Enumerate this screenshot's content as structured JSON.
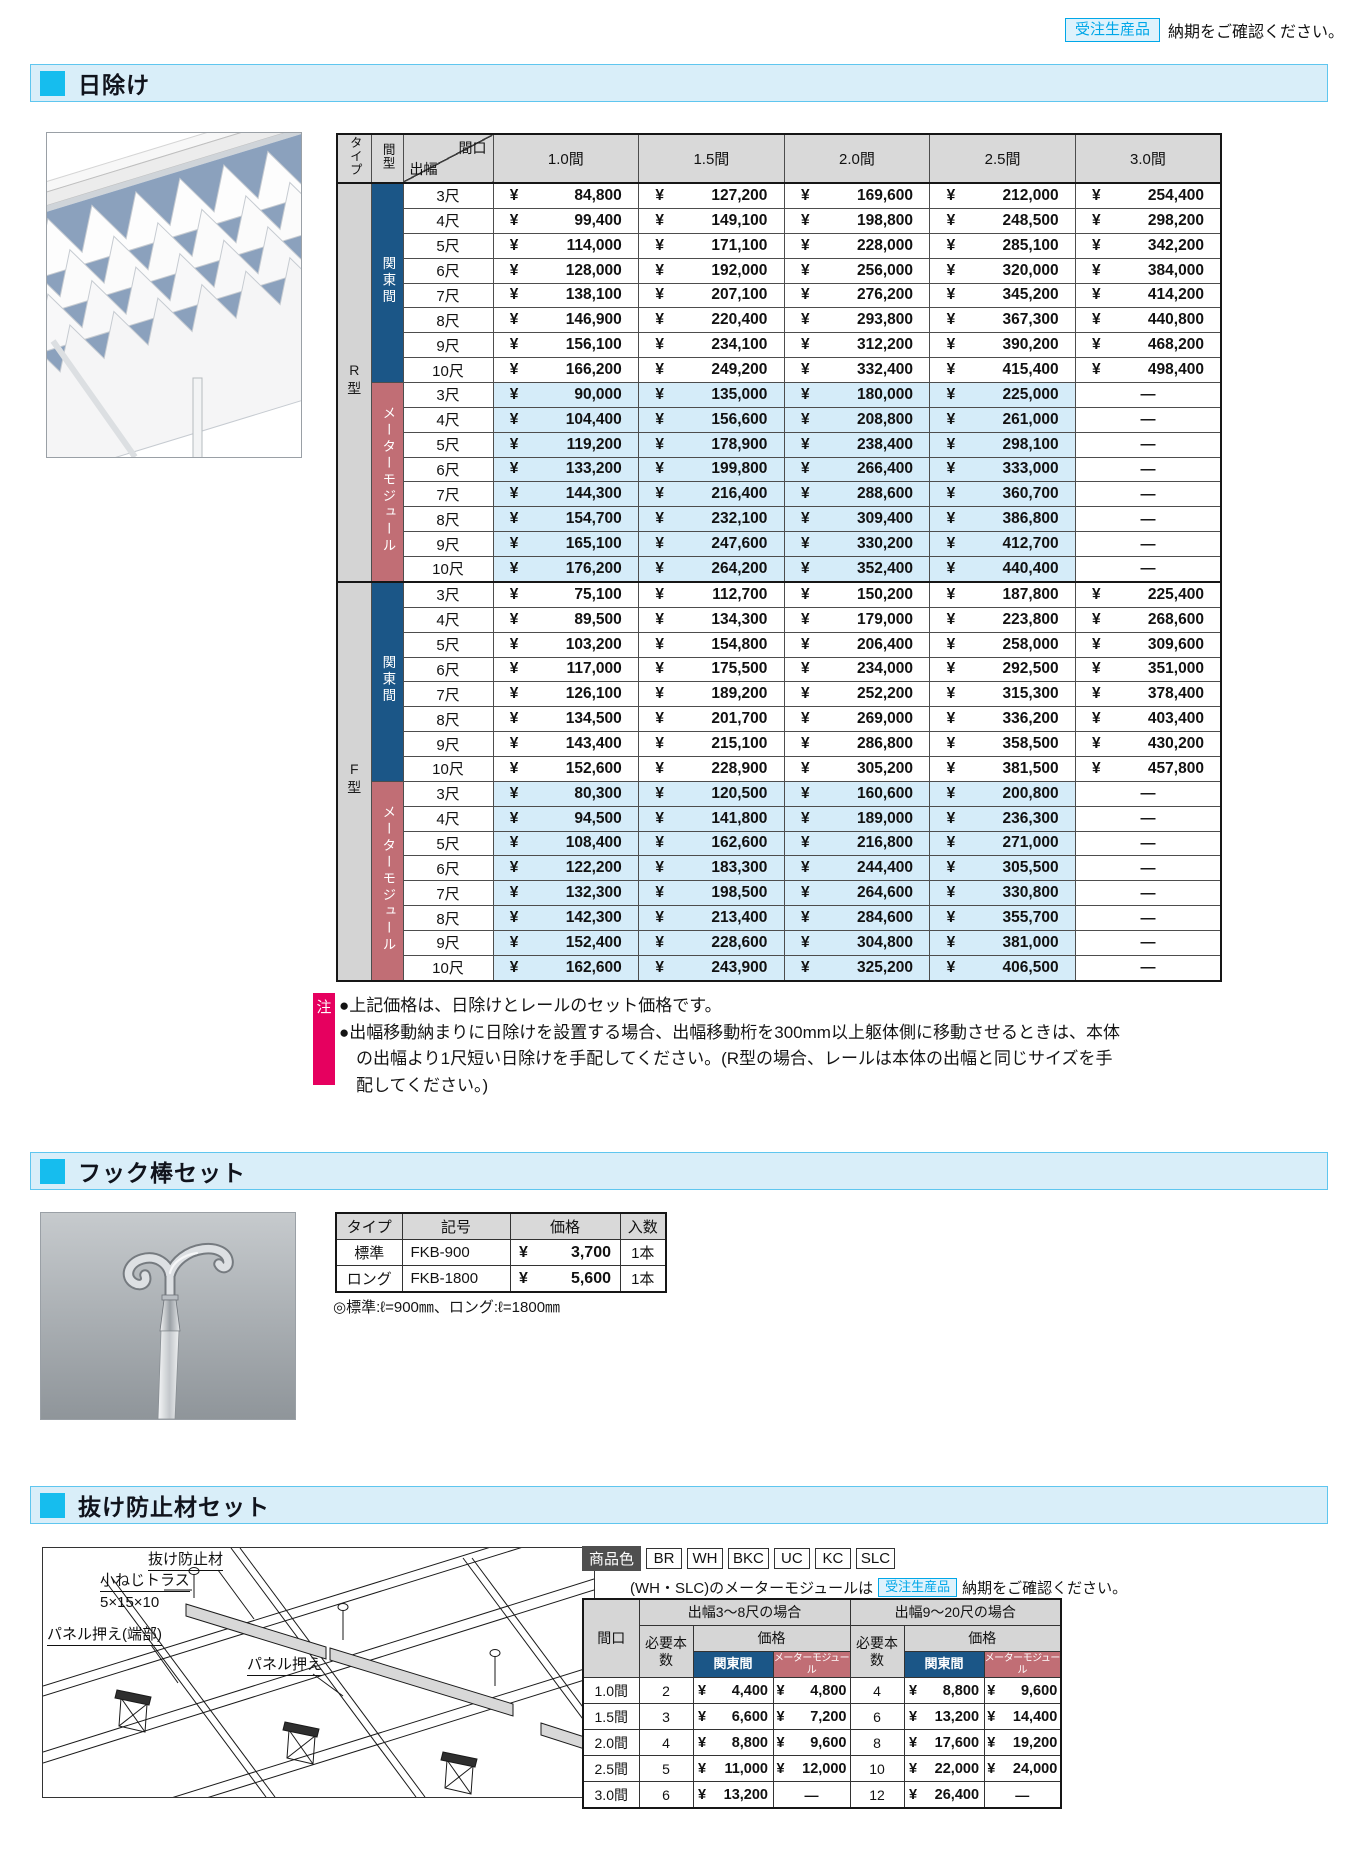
{
  "page": {
    "top_note": {
      "badge": "受注生産品",
      "text": "納期をご確認ください。"
    }
  },
  "colors": {
    "accent_cyan": "#16bdee",
    "section_bar_bg": "#d9eef9",
    "navy_header": "#1b5687",
    "rose_header": "#c16e75",
    "light_blue_cell": "#d5ecf9",
    "note_pink": "#e6005f",
    "badge_cyan": "#00a7e8"
  },
  "hiyoke": {
    "title": "日除け",
    "note_label": "注",
    "notes": [
      "●上記価格は、日除けとレールのセット価格です。",
      "●出幅移動納まりに日除けを設置する場合、出幅移動桁を300mm以上躯体側に移動させるときは、本体の出幅より1尺短い日除けを手配してください。(R型の場合、レールは本体の出幅と同じサイズを手配してください。)"
    ],
    "table": {
      "corner_type": "タイプ",
      "corner_span": "間型",
      "diag_top": "間口",
      "diag_bottom": "出幅",
      "columns": [
        "1.0間",
        "1.5間",
        "2.0間",
        "2.5間",
        "3.0間"
      ],
      "groups": [
        {
          "type": "R型",
          "subgroups": [
            {
              "name": "関東間",
              "style": "navy",
              "rows": [
                {
                  "depth": "3尺",
                  "prices": [
                    "84,800",
                    "127,200",
                    "169,600",
                    "212,000",
                    "254,400"
                  ]
                },
                {
                  "depth": "4尺",
                  "prices": [
                    "99,400",
                    "149,100",
                    "198,800",
                    "248,500",
                    "298,200"
                  ]
                },
                {
                  "depth": "5尺",
                  "prices": [
                    "114,000",
                    "171,100",
                    "228,000",
                    "285,100",
                    "342,200"
                  ]
                },
                {
                  "depth": "6尺",
                  "prices": [
                    "128,000",
                    "192,000",
                    "256,000",
                    "320,000",
                    "384,000"
                  ]
                },
                {
                  "depth": "7尺",
                  "prices": [
                    "138,100",
                    "207,100",
                    "276,200",
                    "345,200",
                    "414,200"
                  ]
                },
                {
                  "depth": "8尺",
                  "prices": [
                    "146,900",
                    "220,400",
                    "293,800",
                    "367,300",
                    "440,800"
                  ]
                },
                {
                  "depth": "9尺",
                  "prices": [
                    "156,100",
                    "234,100",
                    "312,200",
                    "390,200",
                    "468,200"
                  ]
                },
                {
                  "depth": "10尺",
                  "prices": [
                    "166,200",
                    "249,200",
                    "332,400",
                    "415,400",
                    "498,400"
                  ]
                }
              ]
            },
            {
              "name": "メーターモジュール",
              "style": "rose",
              "rows": [
                {
                  "depth": "3尺",
                  "prices": [
                    "90,000",
                    "135,000",
                    "180,000",
                    "225,000",
                    null
                  ]
                },
                {
                  "depth": "4尺",
                  "prices": [
                    "104,400",
                    "156,600",
                    "208,800",
                    "261,000",
                    null
                  ]
                },
                {
                  "depth": "5尺",
                  "prices": [
                    "119,200",
                    "178,900",
                    "238,400",
                    "298,100",
                    null
                  ]
                },
                {
                  "depth": "6尺",
                  "prices": [
                    "133,200",
                    "199,800",
                    "266,400",
                    "333,000",
                    null
                  ]
                },
                {
                  "depth": "7尺",
                  "prices": [
                    "144,300",
                    "216,400",
                    "288,600",
                    "360,700",
                    null
                  ]
                },
                {
                  "depth": "8尺",
                  "prices": [
                    "154,700",
                    "232,100",
                    "309,400",
                    "386,800",
                    null
                  ]
                },
                {
                  "depth": "9尺",
                  "prices": [
                    "165,100",
                    "247,600",
                    "330,200",
                    "412,700",
                    null
                  ]
                },
                {
                  "depth": "10尺",
                  "prices": [
                    "176,200",
                    "264,200",
                    "352,400",
                    "440,400",
                    null
                  ]
                }
              ]
            }
          ]
        },
        {
          "type": "F型",
          "subgroups": [
            {
              "name": "関東間",
              "style": "navy",
              "rows": [
                {
                  "depth": "3尺",
                  "prices": [
                    "75,100",
                    "112,700",
                    "150,200",
                    "187,800",
                    "225,400"
                  ]
                },
                {
                  "depth": "4尺",
                  "prices": [
                    "89,500",
                    "134,300",
                    "179,000",
                    "223,800",
                    "268,600"
                  ]
                },
                {
                  "depth": "5尺",
                  "prices": [
                    "103,200",
                    "154,800",
                    "206,400",
                    "258,000",
                    "309,600"
                  ]
                },
                {
                  "depth": "6尺",
                  "prices": [
                    "117,000",
                    "175,500",
                    "234,000",
                    "292,500",
                    "351,000"
                  ]
                },
                {
                  "depth": "7尺",
                  "prices": [
                    "126,100",
                    "189,200",
                    "252,200",
                    "315,300",
                    "378,400"
                  ]
                },
                {
                  "depth": "8尺",
                  "prices": [
                    "134,500",
                    "201,700",
                    "269,000",
                    "336,200",
                    "403,400"
                  ]
                },
                {
                  "depth": "9尺",
                  "prices": [
                    "143,400",
                    "215,100",
                    "286,800",
                    "358,500",
                    "430,200"
                  ]
                },
                {
                  "depth": "10尺",
                  "prices": [
                    "152,600",
                    "228,900",
                    "305,200",
                    "381,500",
                    "457,800"
                  ]
                }
              ]
            },
            {
              "name": "メーターモジュール",
              "style": "rose",
              "rows": [
                {
                  "depth": "3尺",
                  "prices": [
                    "80,300",
                    "120,500",
                    "160,600",
                    "200,800",
                    null
                  ]
                },
                {
                  "depth": "4尺",
                  "prices": [
                    "94,500",
                    "141,800",
                    "189,000",
                    "236,300",
                    null
                  ]
                },
                {
                  "depth": "5尺",
                  "prices": [
                    "108,400",
                    "162,600",
                    "216,800",
                    "271,000",
                    null
                  ]
                },
                {
                  "depth": "6尺",
                  "prices": [
                    "122,200",
                    "183,300",
                    "244,400",
                    "305,500",
                    null
                  ]
                },
                {
                  "depth": "7尺",
                  "prices": [
                    "132,300",
                    "198,500",
                    "264,600",
                    "330,800",
                    null
                  ]
                },
                {
                  "depth": "8尺",
                  "prices": [
                    "142,300",
                    "213,400",
                    "284,600",
                    "355,700",
                    null
                  ]
                },
                {
                  "depth": "9尺",
                  "prices": [
                    "152,400",
                    "228,600",
                    "304,800",
                    "381,000",
                    null
                  ]
                },
                {
                  "depth": "10尺",
                  "prices": [
                    "162,600",
                    "243,900",
                    "325,200",
                    "406,500",
                    null
                  ]
                }
              ]
            }
          ]
        }
      ]
    }
  },
  "hook": {
    "title": "フック棒セット",
    "table": {
      "headers": [
        "タイプ",
        "記号",
        "価格",
        "入数"
      ],
      "rows": [
        {
          "type": "標準",
          "code": "FKB-900",
          "price": "3,700",
          "qty": "1本"
        },
        {
          "type": "ロング",
          "code": "FKB-1800",
          "price": "5,600",
          "qty": "1本"
        }
      ]
    },
    "note": "◎標準:ℓ=900㎜、ロング:ℓ=1800㎜"
  },
  "nuke": {
    "title": "抜け防止材セット",
    "diagram_labels": {
      "part": "抜け防止材",
      "screw1": "小ねじトラス",
      "screw2": "5×15×10",
      "panel_edge": "パネル押え(端部)",
      "panel": "パネル押え"
    },
    "colors_label": "商品色",
    "colors": [
      "BR",
      "WH",
      "BKC",
      "UC",
      "KC",
      "SLC"
    ],
    "note": {
      "prefix": "(WH・SLC)のメーターモジュールは",
      "badge": "受注生産品",
      "suffix": "納期をご確認ください。"
    },
    "table": {
      "col_span": "間口",
      "group1": "出幅3〜8尺の場合",
      "group2": "出幅9〜20尺の場合",
      "qty_header": "必要本数",
      "price_header": "価格",
      "kanto": "関東間",
      "meter": "メーターモジュール",
      "rows": [
        {
          "span": "1.0間",
          "qty1": "2",
          "kanto1": "4,400",
          "meter1": "4,800",
          "qty2": "4",
          "kanto2": "8,800",
          "meter2": "9,600"
        },
        {
          "span": "1.5間",
          "qty1": "3",
          "kanto1": "6,600",
          "meter1": "7,200",
          "qty2": "6",
          "kanto2": "13,200",
          "meter2": "14,400"
        },
        {
          "span": "2.0間",
          "qty1": "4",
          "kanto1": "8,800",
          "meter1": "9,600",
          "qty2": "8",
          "kanto2": "17,600",
          "meter2": "19,200"
        },
        {
          "span": "2.5間",
          "qty1": "5",
          "kanto1": "11,000",
          "meter1": "12,000",
          "qty2": "10",
          "kanto2": "22,000",
          "meter2": "24,000"
        },
        {
          "span": "3.0間",
          "qty1": "6",
          "kanto1": "13,200",
          "meter1": null,
          "qty2": "12",
          "kanto2": "26,400",
          "meter2": null
        }
      ]
    }
  },
  "misc": {
    "yen": "¥",
    "dash": "—"
  }
}
